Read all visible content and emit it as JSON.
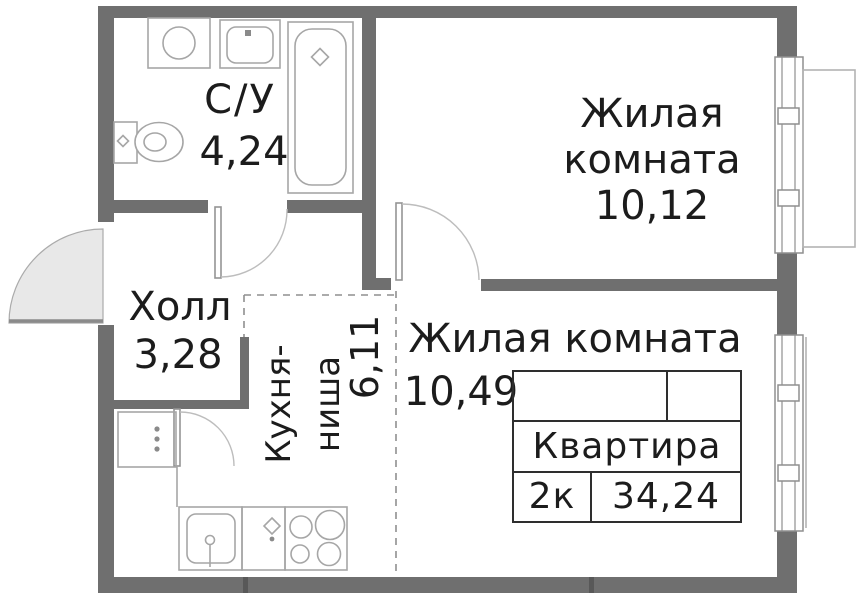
{
  "rooms": {
    "bathroom": {
      "name": "С/У",
      "area": "4,24"
    },
    "living1": {
      "name_line1": "Жилая",
      "name_line2": "комната",
      "area": "10,12"
    },
    "hall": {
      "name": "Холл",
      "area": "3,28"
    },
    "kitchen": {
      "name_line1": "Кухня-",
      "name_line2": "ниша",
      "area": "6,11"
    },
    "living2": {
      "name": "Жилая комната",
      "area": "10,49"
    }
  },
  "info_table": {
    "title": "Квартира",
    "rooms_count": "2к",
    "total_area": "34,24"
  },
  "colors": {
    "wall": "#6f6f6f",
    "fixture": "#a6a6a6",
    "arc": "#bdbdbd",
    "dashed": "#8f8f8f",
    "swing": "#e8e8e8",
    "table_border": "#2e2e2e",
    "text": "#1c1c1c"
  }
}
